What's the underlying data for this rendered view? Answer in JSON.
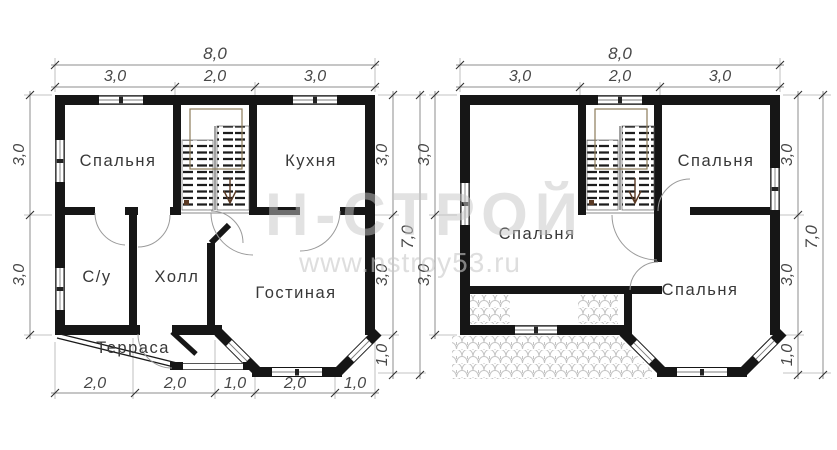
{
  "watermark": {
    "brand": "Н-СТРОЙ",
    "website": "www.nstroy53.ru"
  },
  "colors": {
    "wall": "#161616",
    "dimension_text": "#474747",
    "dimension_line": "#8c8c8c",
    "watermark": "#c6c6c6",
    "stair_outline": "#8d7c5a",
    "roof_hatch": "#c4c4c4"
  },
  "plans": [
    {
      "title": "first-floor-plan",
      "dims": {
        "total_width": "8,0",
        "top": [
          "3,0",
          "2,0",
          "3,0"
        ],
        "left": [
          "3,0",
          "3,0"
        ],
        "right": [
          "3,0",
          "3,0",
          "1,0"
        ],
        "total_height": "7,0",
        "bottom": [
          "2,0",
          "2,0",
          "1,0",
          "2,0",
          "1,0"
        ]
      },
      "rooms": {
        "bedroom": "Спальня",
        "kitchen": "Кухня",
        "bathroom": "С/у",
        "hall": "Холл",
        "living_room": "Гостиная",
        "terrace": "Терраса"
      }
    },
    {
      "title": "second-floor-plan",
      "dims": {
        "total_width": "8,0",
        "top": [
          "3,0",
          "2,0",
          "3,0"
        ],
        "left": [
          "3,0",
          "3,0"
        ],
        "right": [
          "3,0",
          "3,0",
          "1,0"
        ],
        "total_height": "7,0"
      },
      "rooms": {
        "bedroom_top": "Спальня",
        "bedroom_left": "Спальня",
        "bedroom_bottom": "Спальня"
      }
    }
  ]
}
